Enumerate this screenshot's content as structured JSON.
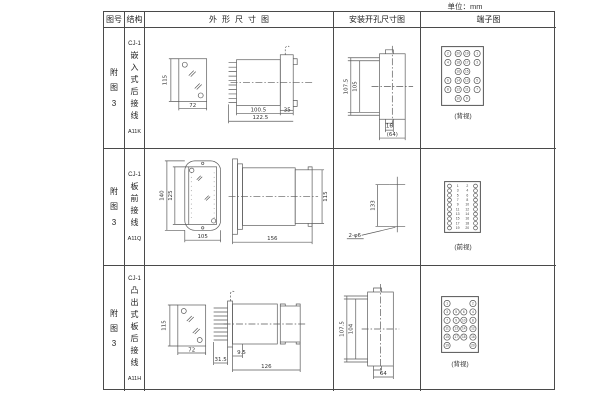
{
  "unit_label": "单位：mm",
  "header": {
    "fig_no": "图号",
    "structure": "结构",
    "outline": "外形尺寸图",
    "mounting": "安装开孔尺寸图",
    "terminal": "端子图"
  },
  "rows": [
    {
      "fig_no": "附图3",
      "model_prefix": "CJ-1",
      "structure_cn": "嵌入式后接线",
      "model": "A11K",
      "outline_dims": {
        "height": "115",
        "width": "72",
        "body_len": "100.5",
        "total_len": "122.5",
        "flange": "35"
      },
      "mount_dims": {
        "outer_h": "107.5",
        "inner_h": "105",
        "w_inner": "16",
        "w_outer": "(64)"
      },
      "terminal": {
        "caption": "(背视)",
        "layout": "quad",
        "two_pos": "inner",
        "rows": [
          [
            2,
            20,
            19,
            1
          ],
          [
            4,
            18,
            17,
            3
          ],
          [
            16,
            15
          ],
          [
            6,
            14,
            13,
            5
          ],
          [
            8,
            12,
            11,
            7
          ],
          [
            10,
            9
          ]
        ]
      }
    },
    {
      "fig_no": "附图3",
      "model_prefix": "CJ-1",
      "structure_cn": "板前接线",
      "model": "A11Q",
      "outline_dims": {
        "outer_h": "140",
        "inner_h": "125",
        "width": "105",
        "length": "156",
        "side_h": "115"
      },
      "mount_dims": {
        "pitch": "133",
        "holes": "2-φ6"
      },
      "terminal": {
        "caption": "(前视)",
        "layout": "dual",
        "rows": [
          [
            1,
            2
          ],
          [
            3,
            4
          ],
          [
            5,
            6
          ],
          [
            7,
            8
          ],
          [
            9,
            10
          ],
          [
            11,
            12
          ],
          [
            13,
            14
          ],
          [
            15,
            16
          ],
          [
            17,
            18
          ],
          [
            19,
            20
          ]
        ]
      }
    },
    {
      "fig_no": "附图3",
      "model_prefix": "CJ-1",
      "structure_cn": "凸出式板后接线",
      "model": "A11H",
      "outline_dims": {
        "height": "115",
        "width": "72",
        "pin_len": "31.5",
        "step": "9.5",
        "length": "126"
      },
      "mount_dims": {
        "outer_h": "107.5",
        "inner_h": "104",
        "width": "64"
      },
      "terminal": {
        "caption": "(背视)",
        "layout": "quad",
        "two_pos": "outer",
        "rows": [
          [
            1,
            2
          ],
          [
            3,
            5,
            6,
            4
          ],
          [
            7,
            9,
            10,
            8
          ],
          [
            11,
            13,
            14,
            12
          ],
          [
            15,
            17,
            18,
            16
          ],
          [
            19,
            20
          ]
        ]
      }
    }
  ]
}
